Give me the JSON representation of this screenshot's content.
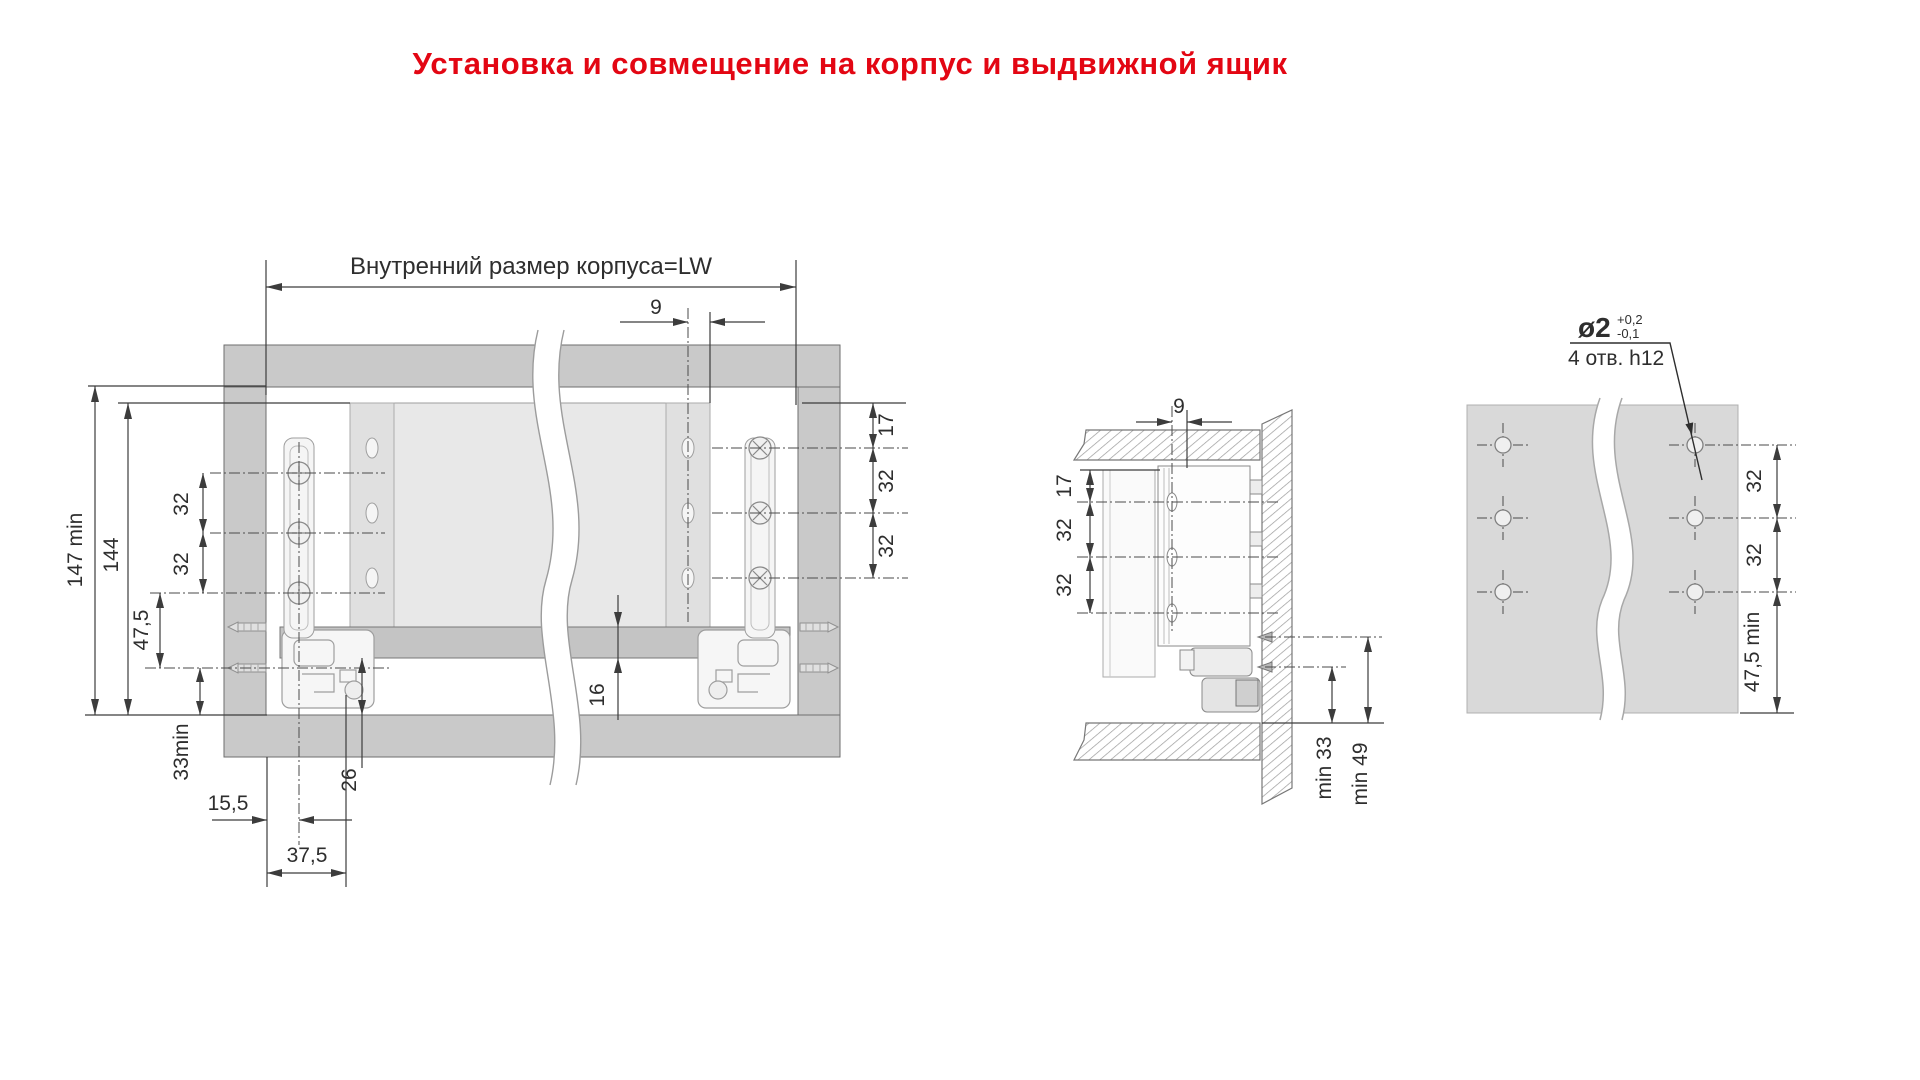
{
  "title": "Установка и совмещение на корпус и выдвижной ящик",
  "colors": {
    "title_red": "#e30613",
    "carcass_gray": "#c9c9c9",
    "panel_gray": "#e8e8e8",
    "drawer_bottom_gray": "#c4c4c4",
    "drill_panel_gray": "#d9d9d9",
    "line": "#3c3c3c"
  },
  "front_view": {
    "lw_label": "Внутренний размер корпуса=LW",
    "dims": {
      "offset_9": "9",
      "right_17": "17",
      "right_32_top": "32",
      "right_32_bottom": "32",
      "height_147": "147 min",
      "height_144": "144",
      "left_32_top": "32",
      "left_32_bottom": "32",
      "left_47_5": "47,5",
      "left_33": "33min",
      "bottom_15_5": "15,5",
      "bottom_37_5": "37,5",
      "gap_26": "26",
      "board_16": "16"
    }
  },
  "section_view": {
    "dims": {
      "offset_9": "9",
      "top_17": "17",
      "mid_32": "32",
      "low_32": "32",
      "min_33": "min 33",
      "min_49": "min 49"
    }
  },
  "drill_view": {
    "callout": {
      "diameter": "ø2",
      "tol_plus": "+0,2",
      "tol_minus": "-0,1",
      "note": "4 отв. h12"
    },
    "dims": {
      "step_32_top": "32",
      "step_32_bottom": "32",
      "edge_47_5": "47,5 min"
    }
  }
}
